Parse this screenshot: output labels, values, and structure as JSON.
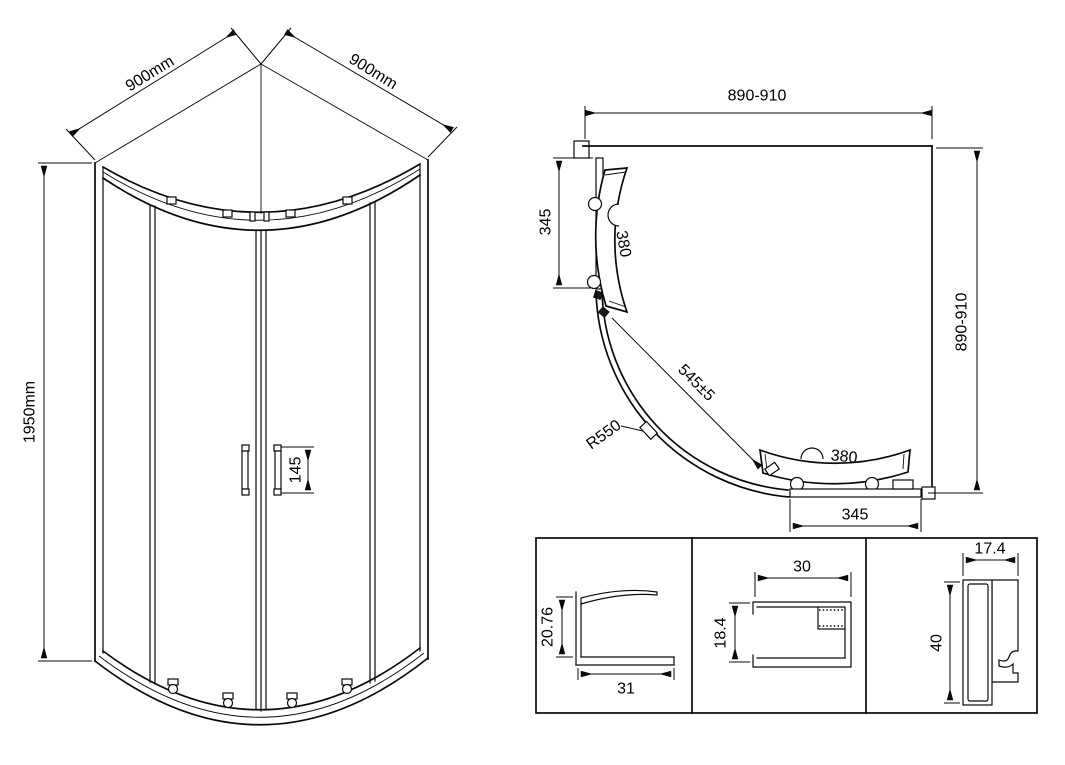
{
  "drawing_title": "quadrant-shower-enclosure-technical-drawing",
  "colors": {
    "line": "#0a0a0a",
    "background": "#ffffff"
  },
  "front_view": {
    "top_left_width": "900mm",
    "top_right_width": "900mm",
    "height": "1950mm",
    "handle_length": "145"
  },
  "plan_view": {
    "top_width": "890-910",
    "side_depth": "890-910",
    "left_fixed_panel": "345",
    "bottom_fixed_panel": "345",
    "left_door_width": "380",
    "bottom_door_width": "380",
    "door_diagonal": "545±5",
    "radius": "R550"
  },
  "profile_details": [
    {
      "height": "20.76",
      "width": "31"
    },
    {
      "height": "18.4",
      "width": "30"
    },
    {
      "height": "40",
      "width": "17.4"
    }
  ]
}
